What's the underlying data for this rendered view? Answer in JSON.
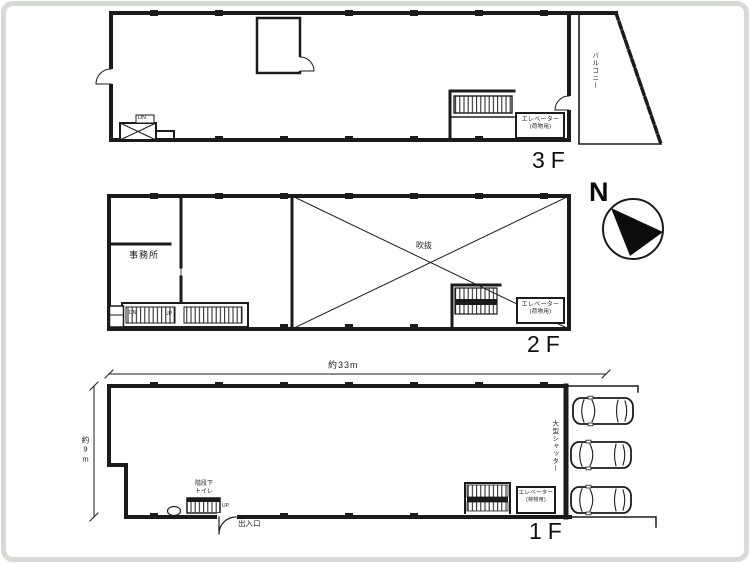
{
  "colors": {
    "ink": "#1b1b1b",
    "paper": "#ffffff",
    "frame": "#d6dbd6"
  },
  "compass": {
    "north_label": "N"
  },
  "floor3": {
    "label": "3F",
    "stair_box_label": "DN",
    "balcony_label": "バルコニー",
    "elevator_line1": "エレベーター",
    "elevator_line2": "(荷物用)"
  },
  "floor2": {
    "label": "2F",
    "office_label": "事務所",
    "void_label": "吹抜",
    "stair_down_label": "DN",
    "stair_up_label": "UP",
    "elevator_line1": "エレベーター",
    "elevator_line2": "(荷物用)"
  },
  "floor1": {
    "label": "1F",
    "width_dimension": "約33m",
    "depth_dimension": "約9m",
    "stair_note_line1": "階段下",
    "stair_note_line2": "トイレ",
    "stair_up_label": "UP",
    "entrance_label": "出入口",
    "shutter_label": "大型シャッター",
    "elevator_line1": "エレベーター",
    "elevator_line2": "(荷物用)",
    "parking_car_count": 3
  }
}
